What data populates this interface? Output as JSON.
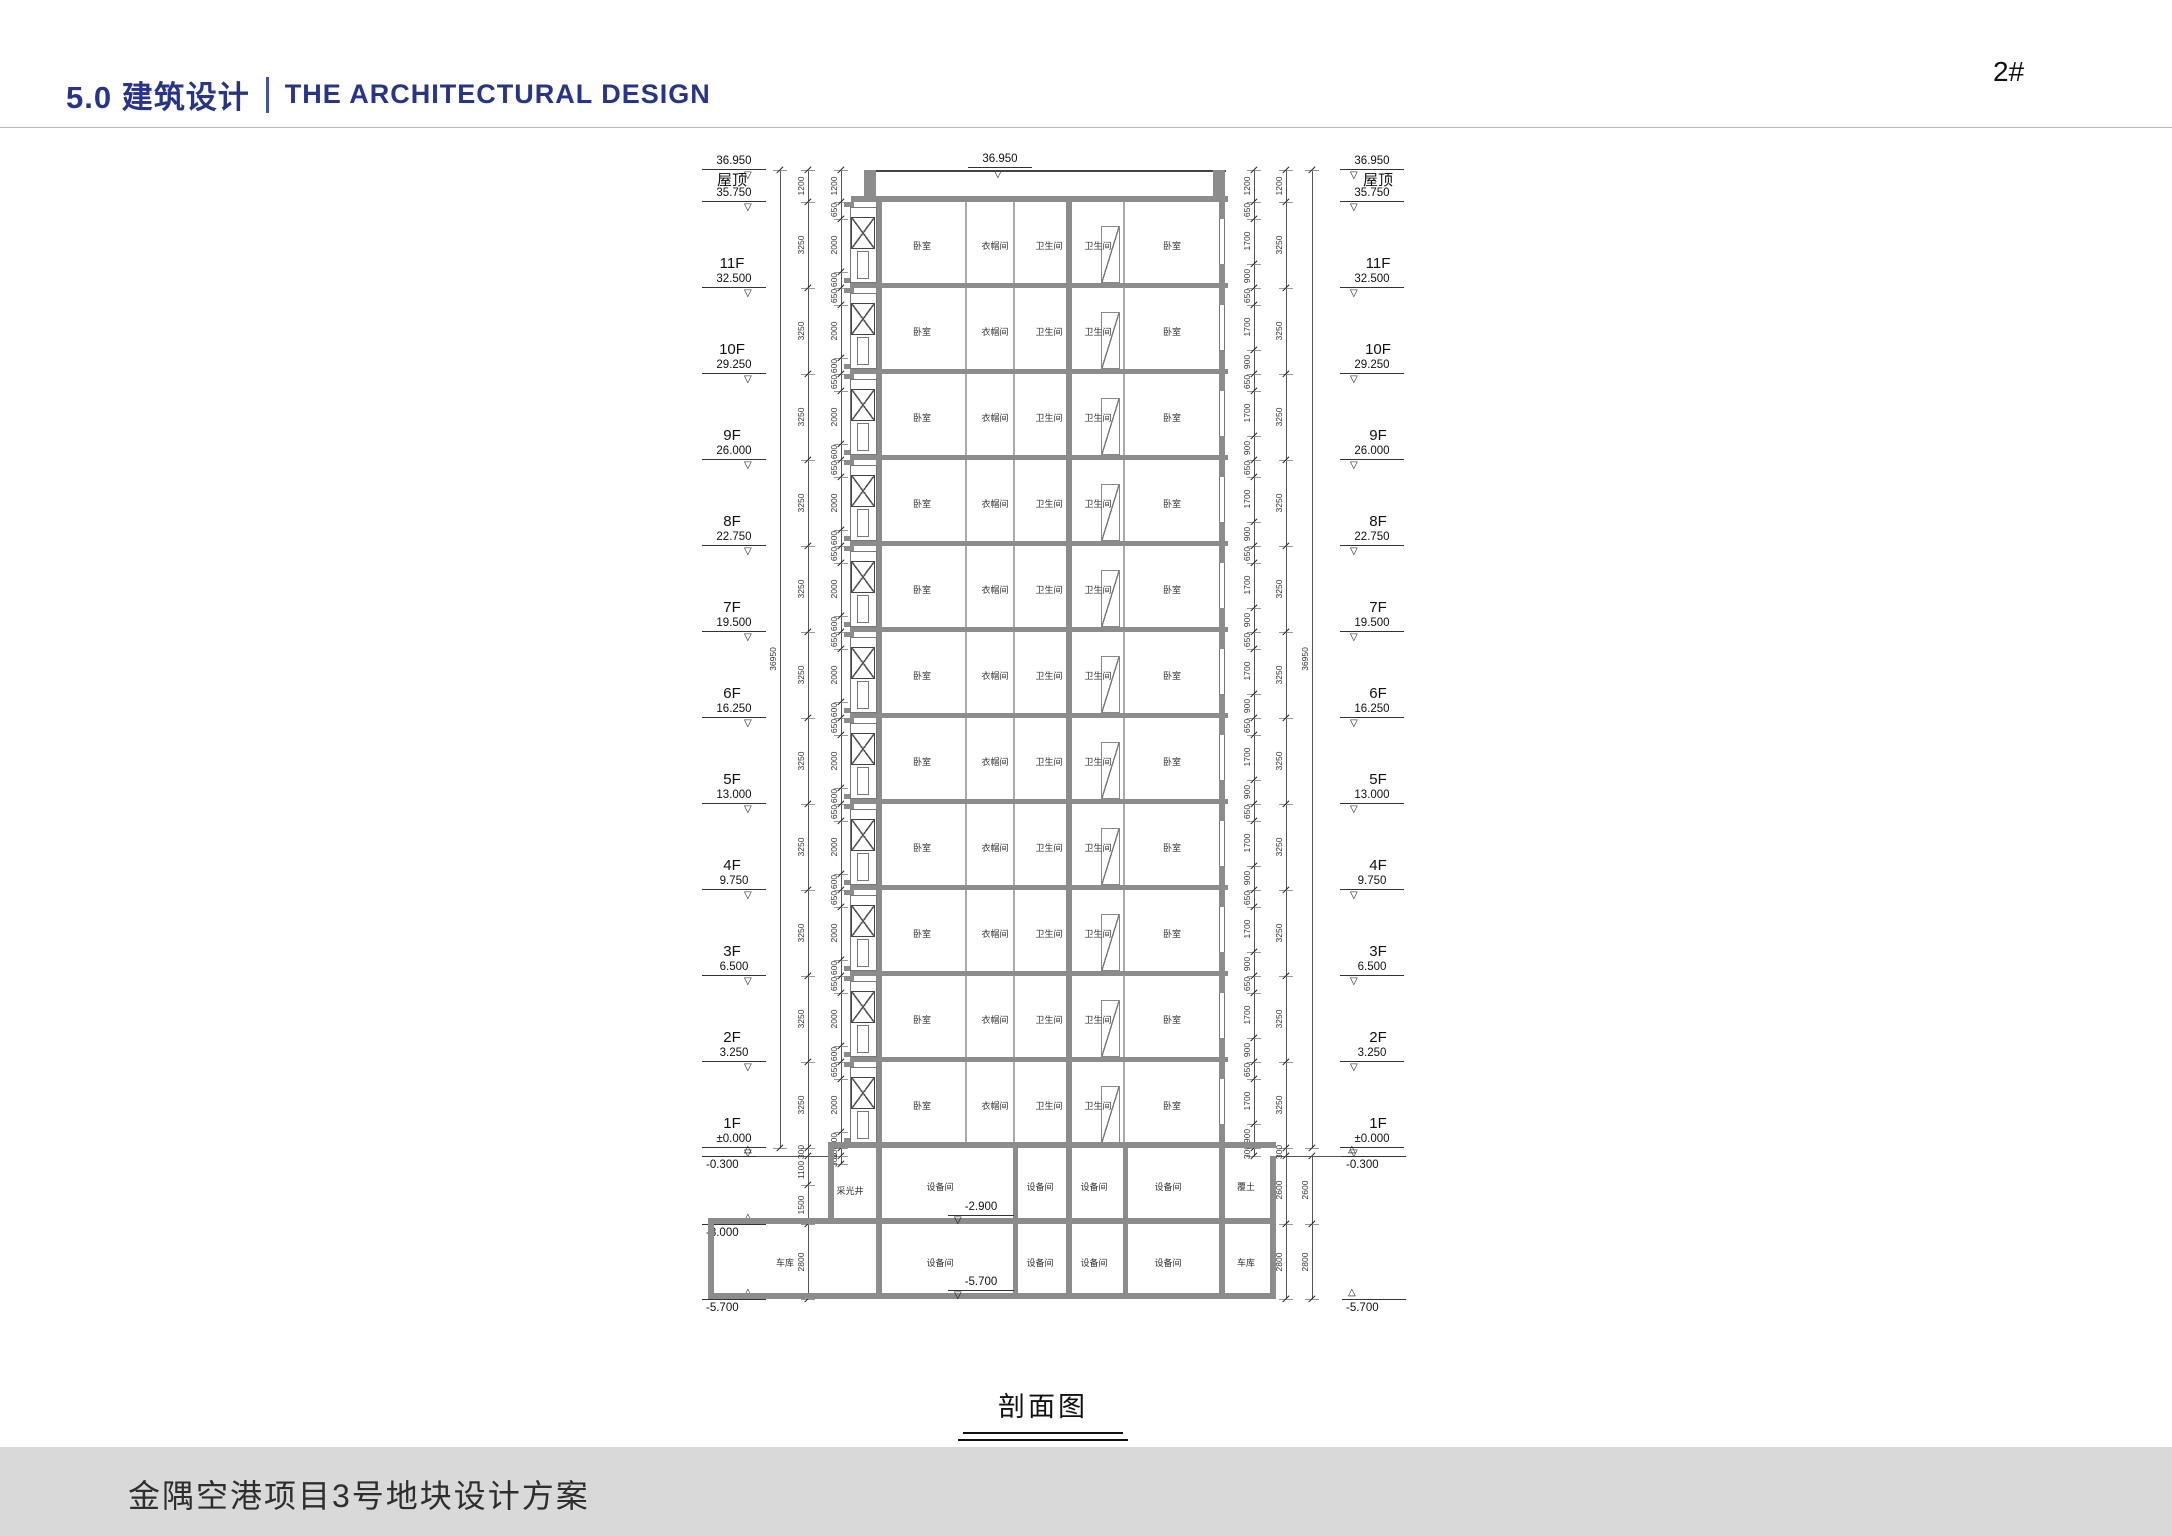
{
  "header": {
    "title_cn": "5.0 建筑设计",
    "title_en": "THE ARCHITECTURAL  DESIGN",
    "sheet_label": "2#",
    "accent_color": "#27348b"
  },
  "footer": {
    "project_title": "金隅空港项目3号地块设计方案",
    "bar_color": "#d9d9d9"
  },
  "drawing": {
    "caption": "剖面图",
    "top_level": {
      "elev": "36.950"
    },
    "roof_level": {
      "name": "屋顶",
      "elev": "35.750"
    },
    "floors": [
      {
        "name": "11F",
        "elev": "32.500"
      },
      {
        "name": "10F",
        "elev": "29.250"
      },
      {
        "name": "9F",
        "elev": "26.000"
      },
      {
        "name": "8F",
        "elev": "22.750"
      },
      {
        "name": "7F",
        "elev": "19.500"
      },
      {
        "name": "6F",
        "elev": "16.250"
      },
      {
        "name": "5F",
        "elev": "13.000"
      },
      {
        "name": "4F",
        "elev": "9.750"
      },
      {
        "name": "3F",
        "elev": "6.500"
      },
      {
        "name": "2F",
        "elev": "3.250"
      },
      {
        "name": "1F",
        "elev": "±0.000"
      }
    ],
    "below_levels_left": [
      "-0.300",
      "-3.000",
      "-5.700"
    ],
    "below_levels_right": [
      "-0.300",
      "-5.700"
    ],
    "typical_rooms": [
      "卧室",
      "衣帽间",
      "卫生间",
      "卫生间",
      "卧室"
    ],
    "b1_rooms": [
      "采光井",
      "设备间",
      "设备间",
      "设备间",
      "设备间",
      "覆土"
    ],
    "b2_rooms": [
      "车库",
      "设备间",
      "设备间",
      "设备间",
      "设备间",
      "车库"
    ],
    "b1_level": "-2.900",
    "b2_level": "-5.700",
    "dims": {
      "total": "36950",
      "parapet": "1200",
      "floor": "3250",
      "left_inner": [
        "650",
        "2000",
        "600"
      ],
      "right_inner": [
        "650",
        "1700",
        "900"
      ],
      "left_below_outer": [
        "300",
        "1100",
        "1500",
        "2800"
      ],
      "left_below_inner": [
        "300",
        "300"
      ],
      "right_below": [
        "300",
        "2600",
        "2800"
      ]
    }
  }
}
